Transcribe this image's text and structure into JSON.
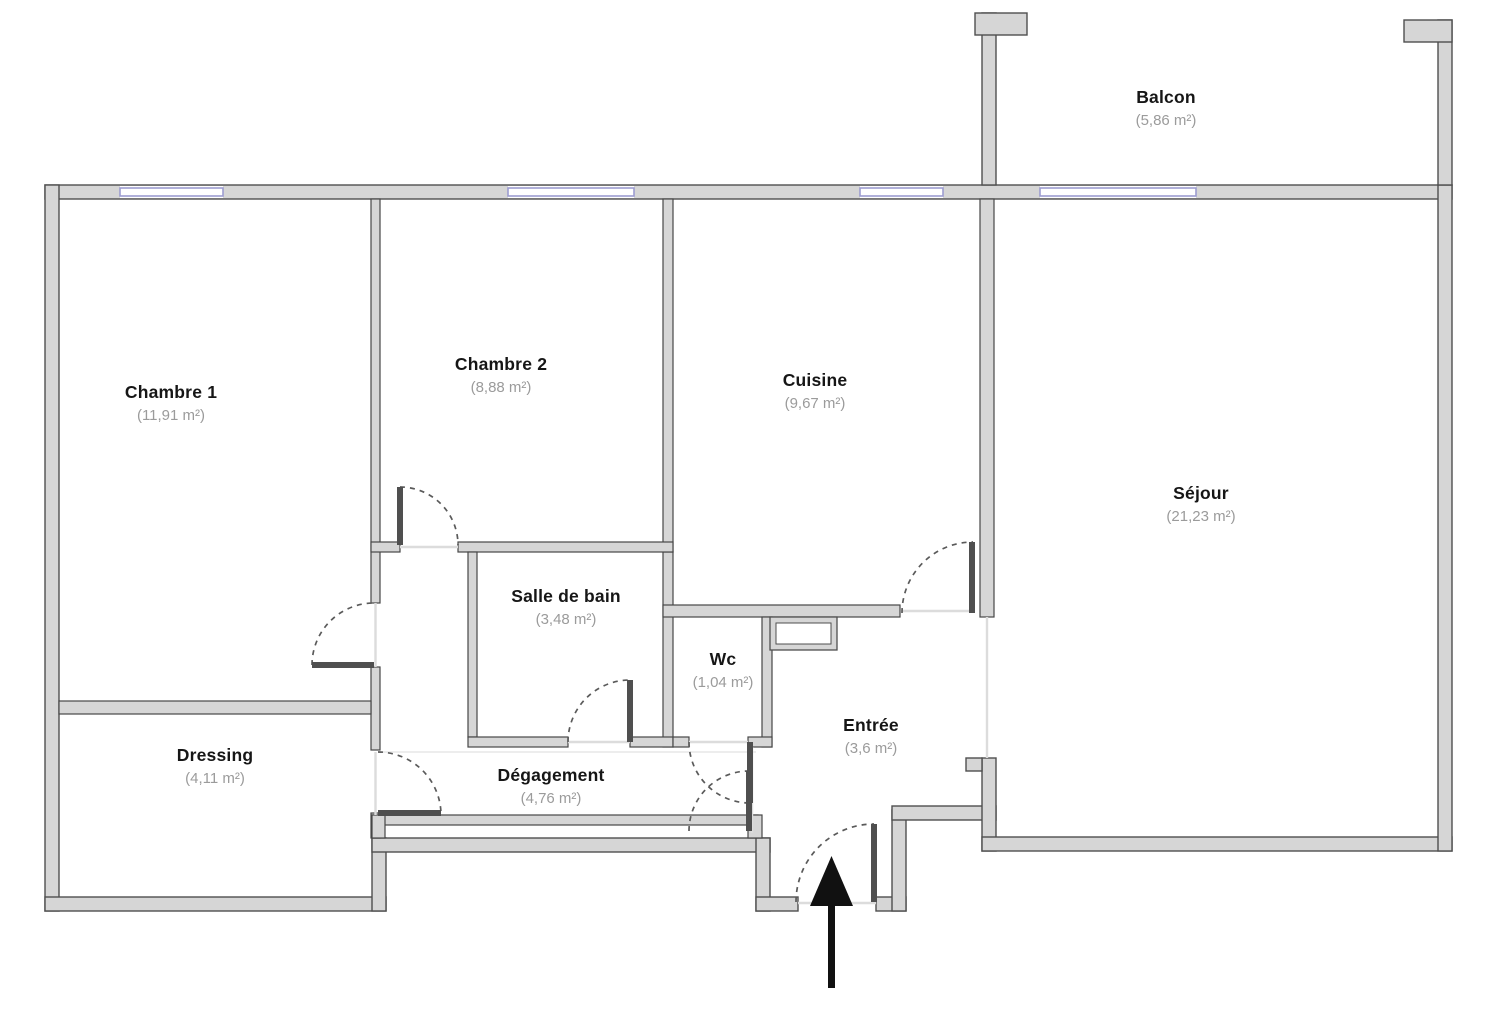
{
  "plan": {
    "type": "apartment-floor-plan",
    "rooms": [
      {
        "id": "chambre1",
        "name": "Chambre 1",
        "area": "(11,91 m²)"
      },
      {
        "id": "chambre2",
        "name": "Chambre 2",
        "area": "(8,88 m²)"
      },
      {
        "id": "cuisine",
        "name": "Cuisine",
        "area": "(9,67 m²)"
      },
      {
        "id": "sejour",
        "name": "Séjour",
        "area": "(21,23 m²)"
      },
      {
        "id": "balcon",
        "name": "Balcon",
        "area": "(5,86 m²)"
      },
      {
        "id": "sdb",
        "name": "Salle de bain",
        "area": "(3,48 m²)"
      },
      {
        "id": "wc",
        "name": "Wc",
        "area": "(1,04 m²)"
      },
      {
        "id": "entree",
        "name": "Entrée",
        "area": "(3,6 m²)"
      },
      {
        "id": "degagement",
        "name": "Dégagement",
        "area": "(4,76 m²)"
      },
      {
        "id": "dressing",
        "name": "Dressing",
        "area": "(4,11 m²)"
      }
    ],
    "icons": {
      "entrance_arrow": "arrow-up-entry-direction"
    },
    "colors": {
      "wall_fill": "#d6d6d6",
      "wall_stroke": "#4f4f4f",
      "window_blue": "#9c9cd0",
      "door_arc": "#5a5a5a",
      "opening_line": "#dcdcdc",
      "arrow": "#111111",
      "room_name_text": "#161616",
      "room_area_text": "#9b9b9b"
    }
  }
}
